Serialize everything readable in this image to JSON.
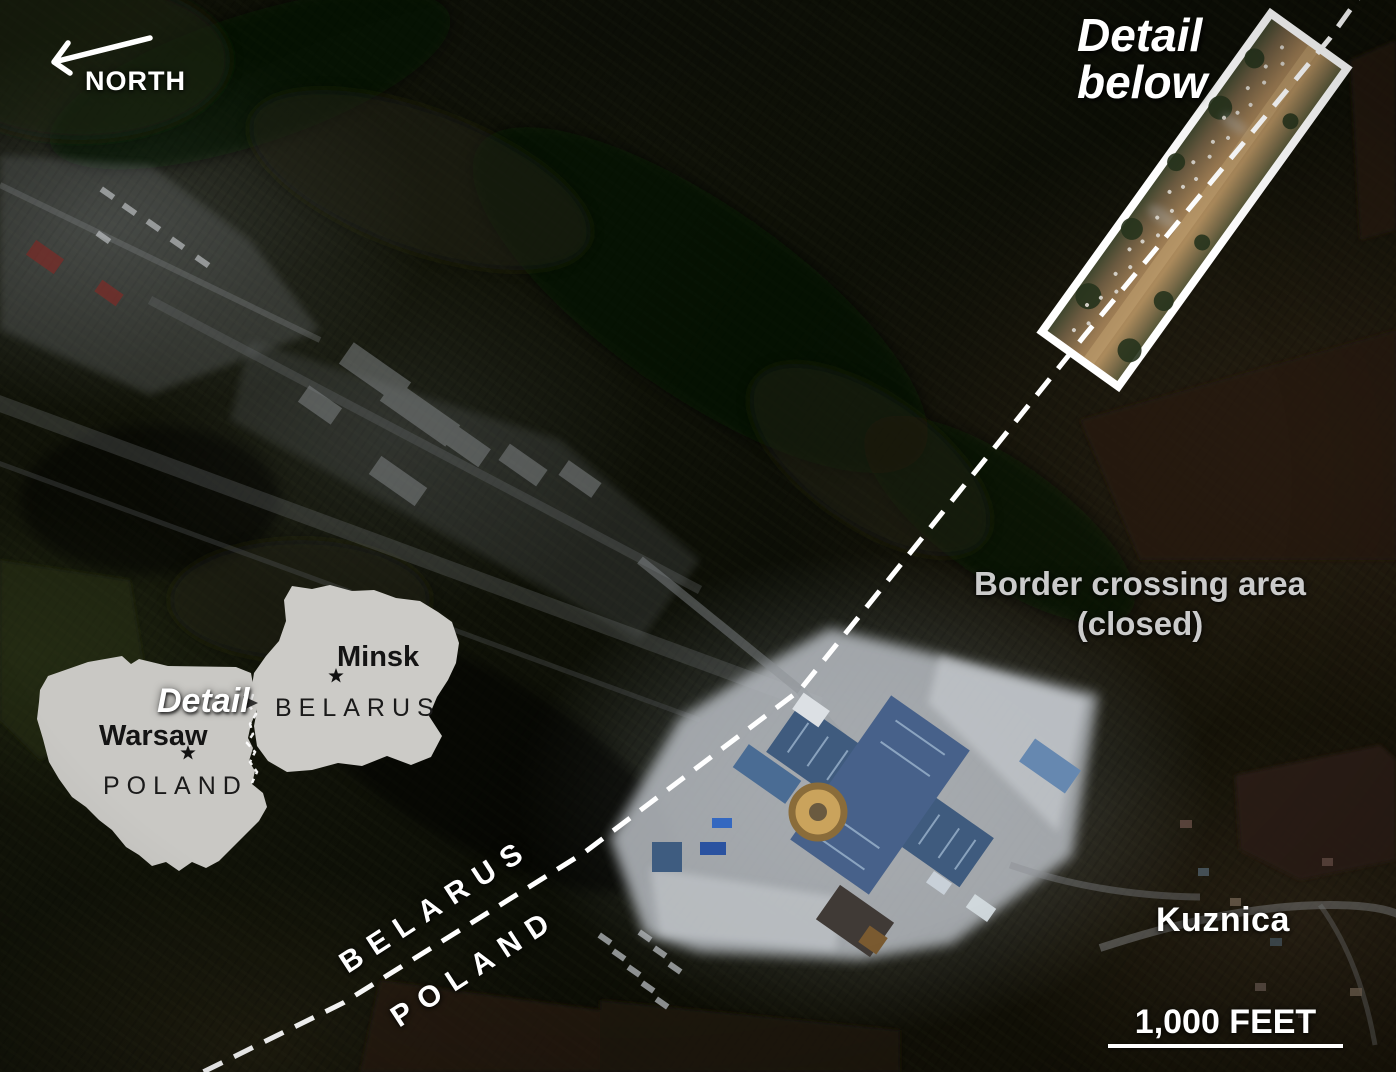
{
  "compass": {
    "label": "NORTH"
  },
  "detail_callout": {
    "line1": "Detail",
    "line2": "below"
  },
  "border_crossing": {
    "line1": "Border crossing area",
    "line2": "(closed)"
  },
  "border_sides": {
    "belarus": "BELARUS",
    "poland": "POLAND"
  },
  "town": {
    "label": "Kuznica"
  },
  "scale_bar": {
    "label": "1,000 FEET"
  },
  "inset": {
    "detail": "Detail",
    "belarus_country": "BELARUS",
    "belarus_capital": "Minsk",
    "poland_country": "POLAND",
    "poland_capital": "Warsaw"
  },
  "colors": {
    "label_white": "#ffffff",
    "label_dim": "#cbcbcb",
    "dashed_border": "#ffffff",
    "inset_land": "#c9c8c4",
    "inset_text": "#141414",
    "highlight_box": "#ffffff",
    "canopy_roof_blue": "#3f5b7e",
    "bright_pavement": "#b3b8bd"
  }
}
